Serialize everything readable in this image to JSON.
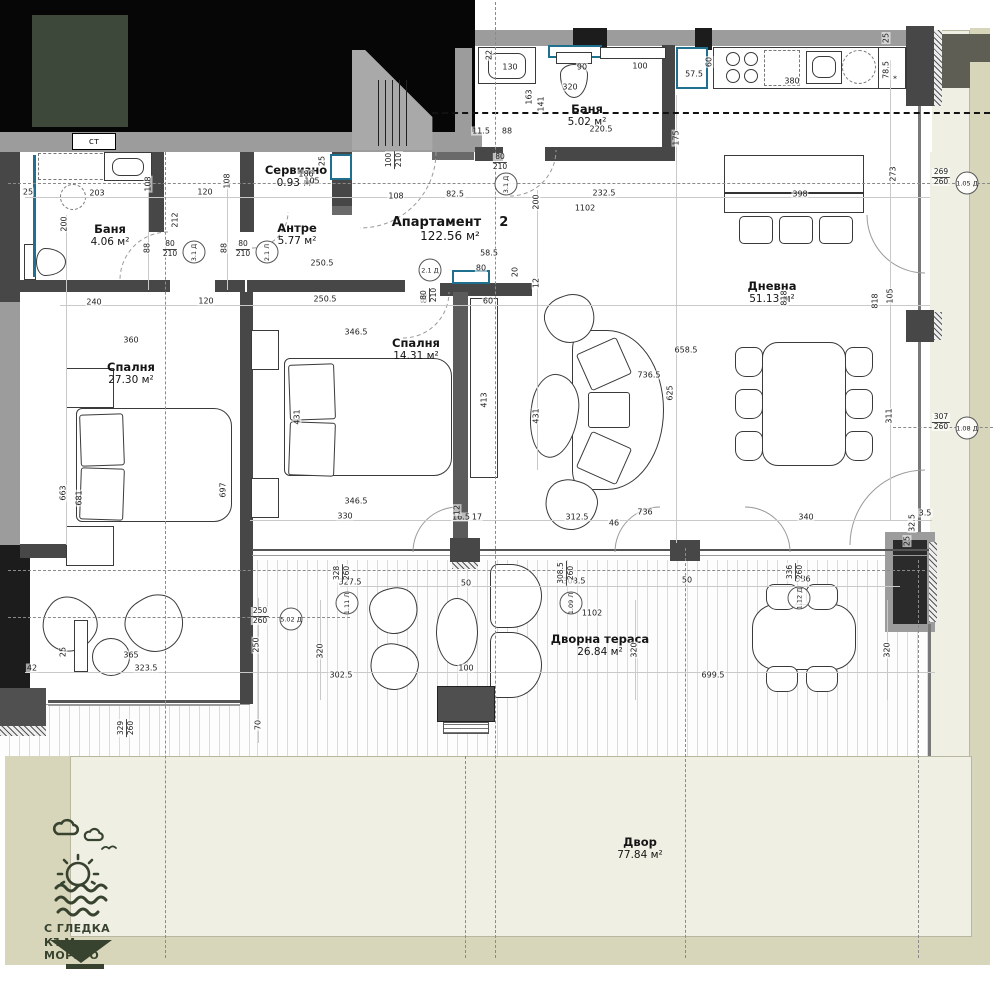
{
  "logo": {
    "line1": "С ГЛЕДКА",
    "line2": "КЪМ МОРЕТО"
  },
  "shaft_label": "ст",
  "colors": {
    "accent": "#1f6f8e",
    "brand": "#37432f",
    "cover_green": "#3d483b",
    "yard_cream": "#f0efe3",
    "yard_khaki": "#d8d6ba",
    "blk": "#060606",
    "g": "#9c9c9c",
    "d": "#474747",
    "k": "#1c1c1c",
    "m": "#6a6a6a",
    "m2": "#5b5b5b",
    "d2": "#505050",
    "k2": "#2b2b2b",
    "olv": "#5e5e55",
    "gl": "#787878",
    "gl2": "#555555",
    "gl3": "#9a9a9a"
  },
  "rooms": [
    {
      "id": "bath-1",
      "name": "Баня",
      "area": "4.06 м²",
      "x": 110,
      "y": 222
    },
    {
      "id": "service",
      "name": "Сервизно",
      "area": "0.93 м²",
      "x": 296,
      "y": 163
    },
    {
      "id": "entry",
      "name": "Антре",
      "area": "5.77 м²",
      "x": 297,
      "y": 221
    },
    {
      "id": "bath-2",
      "name": "Баня",
      "area": "5.02 м²",
      "x": 587,
      "y": 102
    },
    {
      "id": "unit",
      "name": "Апартамент    2",
      "area": "122.56 м²",
      "x": 450,
      "y": 216,
      "big": 1
    },
    {
      "id": "living",
      "name": "Дневна",
      "area": "51.13 м²",
      "x": 772,
      "y": 279
    },
    {
      "id": "bed-1",
      "name": "Спалня",
      "area": "27.30 м²",
      "x": 131,
      "y": 360
    },
    {
      "id": "bed-2",
      "name": "Спалня",
      "area": "14.31 м²",
      "x": 416,
      "y": 336
    },
    {
      "id": "terrace",
      "name": "Дворна тераса",
      "area": "26.84 м²",
      "x": 600,
      "y": 632
    },
    {
      "id": "yard",
      "name": "Двор",
      "area": "77.84 м²",
      "x": 640,
      "y": 835
    }
  ],
  "door_markers": [
    {
      "t": "3.1 Д",
      "x": 194,
      "y": 252,
      "v": 1
    },
    {
      "t": "2.1 Л",
      "x": 267,
      "y": 252,
      "v": 1
    },
    {
      "t": "3.1 Д",
      "x": 506,
      "y": 184,
      "v": 1
    },
    {
      "t": "2.1 Д",
      "x": 430,
      "y": 270
    },
    {
      "t": "1.05 Д",
      "x": 967,
      "y": 183
    },
    {
      "t": "1.08 Д",
      "x": 967,
      "y": 428
    },
    {
      "t": "5.02 Д",
      "x": 291,
      "y": 619
    },
    {
      "t": "1.11 Л",
      "x": 347,
      "y": 603,
      "v": 1
    },
    {
      "t": "1.09 Л",
      "x": 571,
      "y": 603,
      "v": 1
    },
    {
      "t": "1.12 Д",
      "x": 799,
      "y": 598,
      "v": 1
    }
  ],
  "axis_stacks": [
    {
      "a": "269",
      "b": "260",
      "x": 941,
      "y": 177
    },
    {
      "a": "307",
      "b": "260",
      "x": 941,
      "y": 422
    },
    {
      "a": "100",
      "b": "210",
      "x": 394,
      "y": 160,
      "v": 1
    },
    {
      "a": "80",
      "b": "210",
      "x": 170,
      "y": 249
    },
    {
      "a": "80",
      "b": "210",
      "x": 243,
      "y": 249
    },
    {
      "a": "80",
      "b": "210",
      "x": 500,
      "y": 162
    },
    {
      "a": "80",
      "b": "210",
      "x": 429,
      "y": 295,
      "v": 1
    },
    {
      "a": "250",
      "b": "260",
      "x": 260,
      "y": 616
    },
    {
      "a": "328",
      "b": "260",
      "x": 342,
      "y": 573,
      "v": 1
    },
    {
      "a": "308.5",
      "b": "260",
      "x": 566,
      "y": 573,
      "v": 1
    },
    {
      "a": "336",
      "b": "260",
      "x": 795,
      "y": 572,
      "v": 1
    },
    {
      "a": "329",
      "b": "260",
      "x": 126,
      "y": 728,
      "v": 1
    }
  ],
  "dims": [
    {
      "t": "130",
      "x": 510,
      "y": 67
    },
    {
      "t": "90",
      "x": 582,
      "y": 67
    },
    {
      "t": "100",
      "x": 640,
      "y": 66
    },
    {
      "t": "57.5",
      "x": 694,
      "y": 74
    },
    {
      "t": "320",
      "x": 570,
      "y": 87
    },
    {
      "t": "220.5",
      "x": 601,
      "y": 129
    },
    {
      "t": "11.5",
      "x": 481,
      "y": 131
    },
    {
      "t": "88",
      "x": 507,
      "y": 131
    },
    {
      "t": "60",
      "x": 709,
      "y": 62,
      "v": 1
    },
    {
      "t": "380",
      "x": 792,
      "y": 81
    },
    {
      "t": "78.5",
      "x": 886,
      "y": 70,
      "v": 1
    },
    {
      "t": "*",
      "x": 895,
      "y": 79
    },
    {
      "t": "25",
      "x": 886,
      "y": 38,
      "v": 1
    },
    {
      "t": "22",
      "x": 489,
      "y": 55,
      "v": 1
    },
    {
      "t": "163",
      "x": 529,
      "y": 97,
      "v": 1
    },
    {
      "t": "141",
      "x": 541,
      "y": 104,
      "v": 1
    },
    {
      "t": "175",
      "x": 676,
      "y": 138,
      "v": 1
    },
    {
      "t": "25",
      "x": 28,
      "y": 192
    },
    {
      "t": "203",
      "x": 97,
      "y": 193
    },
    {
      "t": "108",
      "x": 148,
      "y": 184,
      "v": 1
    },
    {
      "t": "120",
      "x": 205,
      "y": 192
    },
    {
      "t": "108",
      "x": 227,
      "y": 181,
      "v": 1
    },
    {
      "t": "186",
      "x": 306,
      "y": 174
    },
    {
      "t": "105",
      "x": 312,
      "y": 181
    },
    {
      "t": "25",
      "x": 322,
      "y": 161,
      "v": 1
    },
    {
      "t": "108",
      "x": 396,
      "y": 196
    },
    {
      "t": "82.5",
      "x": 455,
      "y": 194
    },
    {
      "t": "232.5",
      "x": 604,
      "y": 193
    },
    {
      "t": "1102",
      "x": 585,
      "y": 208
    },
    {
      "t": "398",
      "x": 800,
      "y": 194
    },
    {
      "t": "273",
      "x": 893,
      "y": 174,
      "v": 1
    },
    {
      "t": "200",
      "x": 64,
      "y": 224,
      "v": 1
    },
    {
      "t": "200",
      "x": 536,
      "y": 202,
      "v": 1
    },
    {
      "t": "88",
      "x": 147,
      "y": 248,
      "v": 1
    },
    {
      "t": "88",
      "x": 224,
      "y": 248,
      "v": 1
    },
    {
      "t": "212",
      "x": 175,
      "y": 220,
      "v": 1
    },
    {
      "t": "250.5",
      "x": 322,
      "y": 263
    },
    {
      "t": "58.5",
      "x": 489,
      "y": 253
    },
    {
      "t": "80",
      "x": 481,
      "y": 268
    },
    {
      "t": "20",
      "x": 515,
      "y": 272,
      "v": 1
    },
    {
      "t": "12",
      "x": 536,
      "y": 283,
      "v": 1
    },
    {
      "t": "240",
      "x": 94,
      "y": 302
    },
    {
      "t": "120",
      "x": 206,
      "y": 301
    },
    {
      "t": "250.5",
      "x": 325,
      "y": 299
    },
    {
      "t": "60",
      "x": 488,
      "y": 301
    },
    {
      "t": "88",
      "x": 424,
      "y": 298,
      "v": 1
    },
    {
      "t": "360",
      "x": 131,
      "y": 340
    },
    {
      "t": "346.5",
      "x": 356,
      "y": 332
    },
    {
      "t": "658.5",
      "x": 686,
      "y": 350
    },
    {
      "t": "818",
      "x": 784,
      "y": 298,
      "v": 1
    },
    {
      "t": "818",
      "x": 875,
      "y": 301,
      "v": 1
    },
    {
      "t": "105",
      "x": 890,
      "y": 296,
      "v": 1
    },
    {
      "t": "736.5",
      "x": 649,
      "y": 375
    },
    {
      "t": "625",
      "x": 670,
      "y": 393,
      "v": 1
    },
    {
      "t": "431",
      "x": 297,
      "y": 417,
      "v": 1
    },
    {
      "t": "431",
      "x": 536,
      "y": 416,
      "v": 1
    },
    {
      "t": "413",
      "x": 484,
      "y": 400,
      "v": 1
    },
    {
      "t": "663",
      "x": 63,
      "y": 493,
      "v": 1
    },
    {
      "t": "681",
      "x": 79,
      "y": 498,
      "v": 1
    },
    {
      "t": "697",
      "x": 223,
      "y": 490,
      "v": 1
    },
    {
      "t": "311",
      "x": 889,
      "y": 416,
      "v": 1
    },
    {
      "t": "346.5",
      "x": 356,
      "y": 501
    },
    {
      "t": "330",
      "x": 345,
      "y": 516
    },
    {
      "t": "16.5",
      "x": 461,
      "y": 517
    },
    {
      "t": "17",
      "x": 477,
      "y": 517
    },
    {
      "t": "312.5",
      "x": 577,
      "y": 517
    },
    {
      "t": "736",
      "x": 645,
      "y": 512
    },
    {
      "t": "46",
      "x": 614,
      "y": 523
    },
    {
      "t": "340",
      "x": 806,
      "y": 517
    },
    {
      "t": "3.5",
      "x": 925,
      "y": 513
    },
    {
      "t": "32.5",
      "x": 912,
      "y": 523,
      "v": 1
    },
    {
      "t": "25",
      "x": 907,
      "y": 541,
      "v": 1
    },
    {
      "t": "12",
      "x": 457,
      "y": 510,
      "v": 1
    },
    {
      "t": "365",
      "x": 131,
      "y": 655
    },
    {
      "t": "42",
      "x": 32,
      "y": 668
    },
    {
      "t": "323.5",
      "x": 146,
      "y": 668
    },
    {
      "t": "25",
      "x": 63,
      "y": 652,
      "v": 1
    },
    {
      "t": "70",
      "x": 258,
      "y": 725,
      "v": 1
    },
    {
      "t": "250",
      "x": 256,
      "y": 645,
      "v": 1
    },
    {
      "t": "327.5",
      "x": 350,
      "y": 582
    },
    {
      "t": "320",
      "x": 320,
      "y": 651,
      "v": 1
    },
    {
      "t": "302.5",
      "x": 341,
      "y": 675
    },
    {
      "t": "50",
      "x": 466,
      "y": 583
    },
    {
      "t": "100",
      "x": 466,
      "y": 668
    },
    {
      "t": "308.5",
      "x": 574,
      "y": 581
    },
    {
      "t": "1102",
      "x": 592,
      "y": 613
    },
    {
      "t": "320",
      "x": 634,
      "y": 650,
      "v": 1
    },
    {
      "t": "50",
      "x": 687,
      "y": 580
    },
    {
      "t": "699.5",
      "x": 713,
      "y": 675
    },
    {
      "t": "336",
      "x": 803,
      "y": 579
    },
    {
      "t": "320",
      "x": 887,
      "y": 650,
      "v": 1
    }
  ]
}
